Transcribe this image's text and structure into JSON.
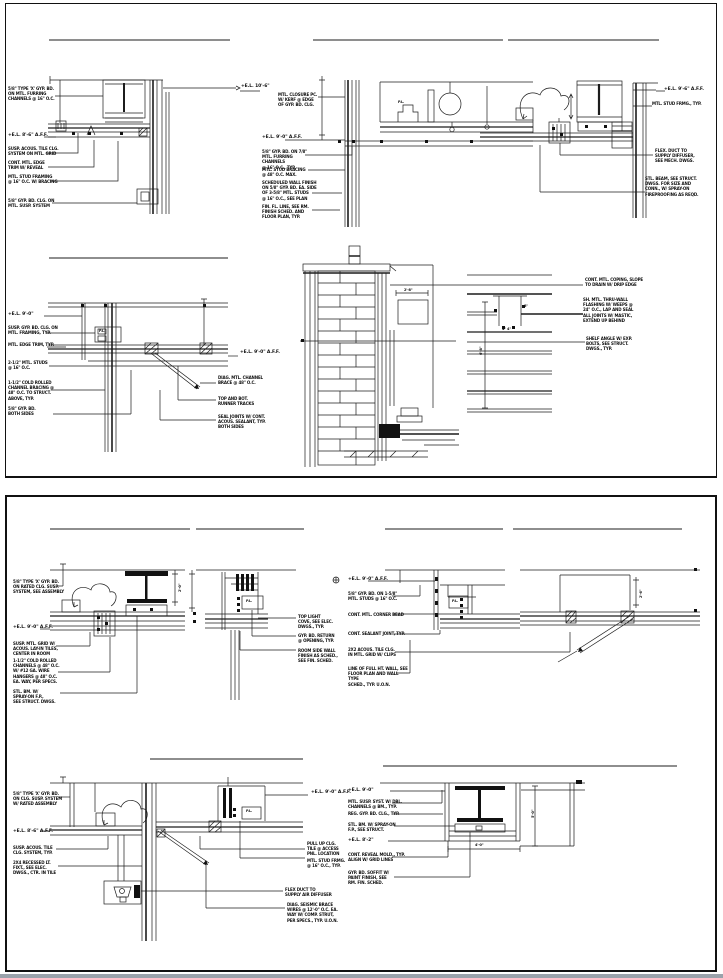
{
  "sheet": {
    "background": "#ffffff",
    "line_color": "#1c1c1c",
    "footer_bar_color": "#9aa2ab",
    "panels": [
      {
        "name": "upper-details-sheet"
      },
      {
        "name": "lower-details-sheet"
      }
    ]
  },
  "annotations": [
    {
      "name": "d1-note-1",
      "x": 8,
      "y": 86,
      "w": 52,
      "text": "5/8\" TYPE 'X' GYP. BD.\nON MTL. FURRING\nCHANNELS @ 16\" O.C."
    },
    {
      "name": "d1-el",
      "x": 8,
      "y": 133,
      "w": 44,
      "cls": "el",
      "text": "+E.L. 8'-6\" A.F.F."
    },
    {
      "name": "d1-note-2",
      "x": 8,
      "y": 146,
      "w": 52,
      "text": "SUSP. ACOUS. TILE CLG.\nSYSTEM ON MTL. GRID"
    },
    {
      "name": "d1-note-3",
      "x": 8,
      "y": 160,
      "w": 48,
      "text": "CONT. MTL. EDGE\nTRIM W/ REVEAL"
    },
    {
      "name": "d1-note-4",
      "x": 8,
      "y": 174,
      "w": 52,
      "text": "MTL. STUD FRAMING\n@ 16\" O.C. W/ BRACING"
    },
    {
      "name": "d1-note-5",
      "x": 8,
      "y": 198,
      "w": 52,
      "text": "5/8\" GYP. BD. CLG. ON\nMTL. SUSP. SYSTEM"
    },
    {
      "name": "d1-el-right",
      "x": 241,
      "y": 84,
      "w": 40,
      "cls": "el",
      "text": "+E.L. 10'-6\""
    },
    {
      "name": "d2-note-top",
      "x": 278,
      "y": 92,
      "w": 44,
      "text": "MTL. CLOSURE PC.\nW/ KERF @ EDGE\nOF GYP. BD. CLG."
    },
    {
      "name": "d2-el",
      "x": 262,
      "y": 135,
      "w": 44,
      "cls": "el",
      "text": "+E.L. 9'-0\" A.F.F."
    },
    {
      "name": "d2-note-1",
      "x": 262,
      "y": 149,
      "w": 54,
      "text": "5/8\" GYP. BD. ON 7/8\"\nMTL. FURRING CHANNELS\n@ 16\" O.C., TYP."
    },
    {
      "name": "d2-note-2",
      "x": 262,
      "y": 167,
      "w": 50,
      "text": "MTL. STUD BRACING\n@ 48\" O.C. MAX."
    },
    {
      "name": "d2-note-3",
      "x": 262,
      "y": 180,
      "w": 56,
      "text": "SCHEDULED WALL FINISH\nON 5/8\" GYP. BD. EA. SIDE\nOF 3-5/8\" MTL. STUDS\n@ 16\" O.C., SEE PLAN"
    },
    {
      "name": "d2-note-4",
      "x": 262,
      "y": 204,
      "w": 52,
      "text": "FIN. FL. LINE, SEE RM.\nFINISH SCHED. AND\nFLOOR PLAN, TYP."
    },
    {
      "name": "d2-pl-label",
      "x": 398,
      "y": 100,
      "w": 12,
      "cls": "dim",
      "text": "P.L."
    },
    {
      "name": "d3-el",
      "x": 664,
      "y": 87,
      "w": 42,
      "cls": "el",
      "text": "+E.L. 9'-6\" A.F.F."
    },
    {
      "name": "d3-note-1",
      "x": 652,
      "y": 101,
      "w": 56,
      "text": "MTL. STUD FRMG., TYP."
    },
    {
      "name": "d3-note-2",
      "x": 655,
      "y": 148,
      "w": 46,
      "text": "FLEX. DUCT TO\nSUPPLY DIFFUSER,\nSEE MECH. DWGS."
    },
    {
      "name": "d3-note-3",
      "x": 645,
      "y": 176,
      "w": 58,
      "text": "STL. BEAM, SEE STRUCT.\nDWGS. FOR SIZE AND\nCONN., W/ SPRAY-ON\nFIREPROOFING AS REQD."
    },
    {
      "name": "d4-el",
      "x": 8,
      "y": 312,
      "w": 36,
      "cls": "el",
      "text": "+E.L. 9'-0\""
    },
    {
      "name": "d4-note-1",
      "x": 8,
      "y": 325,
      "w": 54,
      "text": "SUSP. GYP. BD. CLG. ON\nMTL. FRAMING, TYP."
    },
    {
      "name": "d4-note-2",
      "x": 8,
      "y": 342,
      "w": 52,
      "text": "MTL. EDGE TRIM, TYP."
    },
    {
      "name": "d4-note-3",
      "x": 8,
      "y": 360,
      "w": 48,
      "text": "2-1/2\" MTL. STUDS\n@ 16\" O.C."
    },
    {
      "name": "d4-note-4",
      "x": 8,
      "y": 380,
      "w": 52,
      "text": "1-1/2\" COLD ROLLED\nCHANNEL BRACING @\n48\" O.C. TO STRUCT.\nABOVE, TYP."
    },
    {
      "name": "d4-note-5",
      "x": 8,
      "y": 406,
      "w": 44,
      "text": "5/8\" GYP. BD.\nBOTH SIDES"
    },
    {
      "name": "d4-pl-label",
      "x": 99,
      "y": 329,
      "w": 12,
      "cls": "dim",
      "text": "P.L."
    },
    {
      "name": "d4-el-right",
      "x": 240,
      "y": 350,
      "w": 40,
      "cls": "el",
      "text": "+E.L. 9'-0\" A.F.F."
    },
    {
      "name": "d4-note-r1",
      "x": 218,
      "y": 375,
      "w": 50,
      "text": "DIAG. MTL. CHANNEL\nBRACE @ 48\" O.C."
    },
    {
      "name": "d4-note-r2",
      "x": 218,
      "y": 396,
      "w": 44,
      "text": "TOP AND BOT.\nRUNNER TRACKS"
    },
    {
      "name": "d4-note-r3",
      "x": 218,
      "y": 414,
      "w": 52,
      "text": "SEAL JOINTS W/ CONT.\nACOUS. SEALANT, TYP.\nBOTH SIDES"
    },
    {
      "name": "d5-note-1",
      "x": 585,
      "y": 277,
      "w": 58,
      "text": "CONT. MTL. COPING, SLOPE\nTO DRAIN W/ DRIP EDGE"
    },
    {
      "name": "d5-note-2",
      "x": 583,
      "y": 297,
      "w": 58,
      "text": "SH. MTL. THRU-WALL\nFLASHING W/ WEEPS @\n24\" O.C., LAP AND SEAL\nALL JOINTS W/ MASTIC,\nEXTEND UP BEHIND"
    },
    {
      "name": "d5-note-3",
      "x": 586,
      "y": 336,
      "w": 52,
      "text": "SHELF ANGLE W/ EXP.\nBOLTS, SEE STRUCT.\nDWGS., TYP."
    },
    {
      "name": "d5-dim-1",
      "x": 404,
      "y": 288,
      "w": 20,
      "cls": "dim",
      "text": "2'-8\""
    },
    {
      "name": "d5-dim-2",
      "x": 524,
      "y": 304,
      "w": 12,
      "cls": "dim",
      "text": "8\""
    },
    {
      "name": "d5-dim-3",
      "x": 479,
      "y": 355,
      "w": 16,
      "cls": "dim rot",
      "text": "6'-8\""
    },
    {
      "name": "d5-dim-4",
      "x": 502,
      "y": 327,
      "w": 18,
      "cls": "dim",
      "text": "4\"  4\""
    },
    {
      "name": "d6-note-1",
      "x": 13,
      "y": 579,
      "w": 52,
      "text": "5/8\" TYPE 'X' GYP. BD.\nON RATED CLG. SUSP.\nSYSTEM, SEE ASSEMBLY"
    },
    {
      "name": "d6-el",
      "x": 13,
      "y": 625,
      "w": 44,
      "cls": "el",
      "text": "+E.L. 9'-0\" A.F.F."
    },
    {
      "name": "d6-note-2",
      "x": 13,
      "y": 641,
      "w": 50,
      "text": "SUSP. MTL. GRID W/\nACOUS. LAY-IN TILES,\nCENTER IN ROOM"
    },
    {
      "name": "d6-note-3",
      "x": 13,
      "y": 658,
      "w": 52,
      "text": "1-1/2\" COLD ROLLED\nCHANNELS @ 48\" O.C.\nW/ #12 GA. WIRE\nHANGERS @ 48\" O.C.\nEA. WAY, PER SPECS."
    },
    {
      "name": "d6-note-4",
      "x": 13,
      "y": 689,
      "w": 46,
      "text": "STL. BM. W/\nSPRAY-ON F.P.,\nSEE STRUCT. DWGS."
    },
    {
      "name": "d6-dim",
      "x": 178,
      "y": 592,
      "w": 14,
      "cls": "dim rot",
      "text": "2'-0\""
    },
    {
      "name": "d7-note-1",
      "x": 298,
      "y": 614,
      "w": 40,
      "text": "TOP LIGHT\nCOVE, SEE ELEC.\nDWGS., TYP."
    },
    {
      "name": "d7-note-2",
      "x": 298,
      "y": 633,
      "w": 42,
      "text": "GYP. BD. RETURN\n@ OPENING, TYP."
    },
    {
      "name": "d7-note-3",
      "x": 298,
      "y": 648,
      "w": 44,
      "text": "ROOM SIDE WALL\nFINISH AS SCHED.,\nSEE FIN. SCHED."
    },
    {
      "name": "d7-pl-label",
      "x": 246,
      "y": 599,
      "w": 12,
      "cls": "dim",
      "text": "P.L."
    },
    {
      "name": "d8-el",
      "x": 348,
      "y": 577,
      "w": 44,
      "cls": "el",
      "text": "+E.L. 9'-0\" A.F.F."
    },
    {
      "name": "d8-note-1",
      "x": 348,
      "y": 591,
      "w": 56,
      "text": "5/8\" GYP. BD. ON 1-5/8\"\nMTL. STUDS @ 16\" O.C."
    },
    {
      "name": "d8-note-2",
      "x": 348,
      "y": 612,
      "w": 56,
      "text": "CONT. MTL. CORNER BEAD"
    },
    {
      "name": "d8-note-3",
      "x": 348,
      "y": 631,
      "w": 58,
      "text": "CONT. SEALANT JOINT, TYP."
    },
    {
      "name": "d8-note-4",
      "x": 348,
      "y": 647,
      "w": 54,
      "text": "2X2 ACOUS. TILE CLG.\nIN MTL. GRID W/ CLIPS"
    },
    {
      "name": "d8-note-5",
      "x": 348,
      "y": 666,
      "w": 60,
      "text": "LINE OF FULL HT. WALL, SEE\nFLOOR PLAN AND WALL TYPE\nSCHED., TYP. U.O.N."
    },
    {
      "name": "d8-pl-label",
      "x": 452,
      "y": 599,
      "w": 12,
      "cls": "dim",
      "text": "P.L."
    },
    {
      "name": "d9-dim",
      "x": 639,
      "y": 598,
      "w": 14,
      "cls": "dim rot",
      "text": "2'-6\""
    },
    {
      "name": "d10-note-1",
      "x": 13,
      "y": 791,
      "w": 52,
      "text": "5/8\" TYPE 'X' GYP. BD.\nON CLG. SUSP. SYSTEM\nW/ RATED ASSEMBLY"
    },
    {
      "name": "d10-el",
      "x": 13,
      "y": 829,
      "w": 44,
      "cls": "el",
      "text": "+E.L. 8'-6\" A.F.F."
    },
    {
      "name": "d10-note-2",
      "x": 13,
      "y": 845,
      "w": 46,
      "text": "SUSP. ACOUS. TILE\nCLG. SYSTEM, TYP."
    },
    {
      "name": "d10-note-3",
      "x": 13,
      "y": 860,
      "w": 46,
      "text": "2X4 RECESSED LT.\nFIXT., SEE ELEC.\nDWGS., CTR. IN TILE"
    },
    {
      "name": "d10-el-right",
      "x": 311,
      "y": 790,
      "w": 44,
      "cls": "el",
      "text": "+E.L. 9'-0\" A.F.F."
    },
    {
      "name": "d10-note-r1",
      "x": 307,
      "y": 841,
      "w": 38,
      "text": "PULL UP CLG.\nTILE @ ACCESS\nPNL. LOCATION"
    },
    {
      "name": "d10-note-r2",
      "x": 307,
      "y": 858,
      "w": 40,
      "text": "MTL. STUD FRMG.\n@ 16\" O.C., TYP."
    },
    {
      "name": "d10-note-r3",
      "x": 285,
      "y": 887,
      "w": 50,
      "text": "FLEX DUCT TO\nSUPPLY AIR DIFFUSER"
    },
    {
      "name": "d10-note-r4",
      "x": 287,
      "y": 902,
      "w": 54,
      "text": "DIAG. SEISMIC BRACE\nWIRES @ 12'-0\" O.C. EA.\nWAY W/ COMP. STRUT,\nPER SPECS., TYP. U.O.N."
    },
    {
      "name": "d10-pl-label",
      "x": 246,
      "y": 809,
      "w": 12,
      "cls": "dim",
      "text": "P.L."
    },
    {
      "name": "d11-el-1",
      "x": 348,
      "y": 788,
      "w": 36,
      "cls": "el",
      "text": "+E.L. 9'-0\""
    },
    {
      "name": "d11-note-1",
      "x": 348,
      "y": 799,
      "w": 58,
      "text": "MTL. SUSP. SYST. W/ DBL.\nCHANNELS @ BM., TYP."
    },
    {
      "name": "d11-note-2",
      "x": 348,
      "y": 811,
      "w": 58,
      "text": "REG. GYP. BD. CLG., TYP."
    },
    {
      "name": "d11-note-3",
      "x": 348,
      "y": 822,
      "w": 54,
      "text": "STL. BM. W/ SPRAY-ON\nF.P., SEE STRUCT."
    },
    {
      "name": "d11-el-2",
      "x": 348,
      "y": 838,
      "w": 36,
      "cls": "el",
      "text": "+E.L. 8'-2\""
    },
    {
      "name": "d11-note-4",
      "x": 348,
      "y": 852,
      "w": 60,
      "text": "CONT. REVEAL MOLD., TYP.\nALIGN W/ GRID LINES"
    },
    {
      "name": "d11-note-5",
      "x": 348,
      "y": 870,
      "w": 48,
      "text": "GYP. BD. SOFFIT W/\nPAINT FINISH, SEE\nRM. FIN. SCHED."
    },
    {
      "name": "d11-dim-1",
      "x": 475,
      "y": 843,
      "w": 18,
      "cls": "dim",
      "text": "4'-0\""
    },
    {
      "name": "d11-dim-2",
      "x": 531,
      "y": 818,
      "w": 16,
      "cls": "dim rot",
      "text": "5'-0\""
    }
  ]
}
